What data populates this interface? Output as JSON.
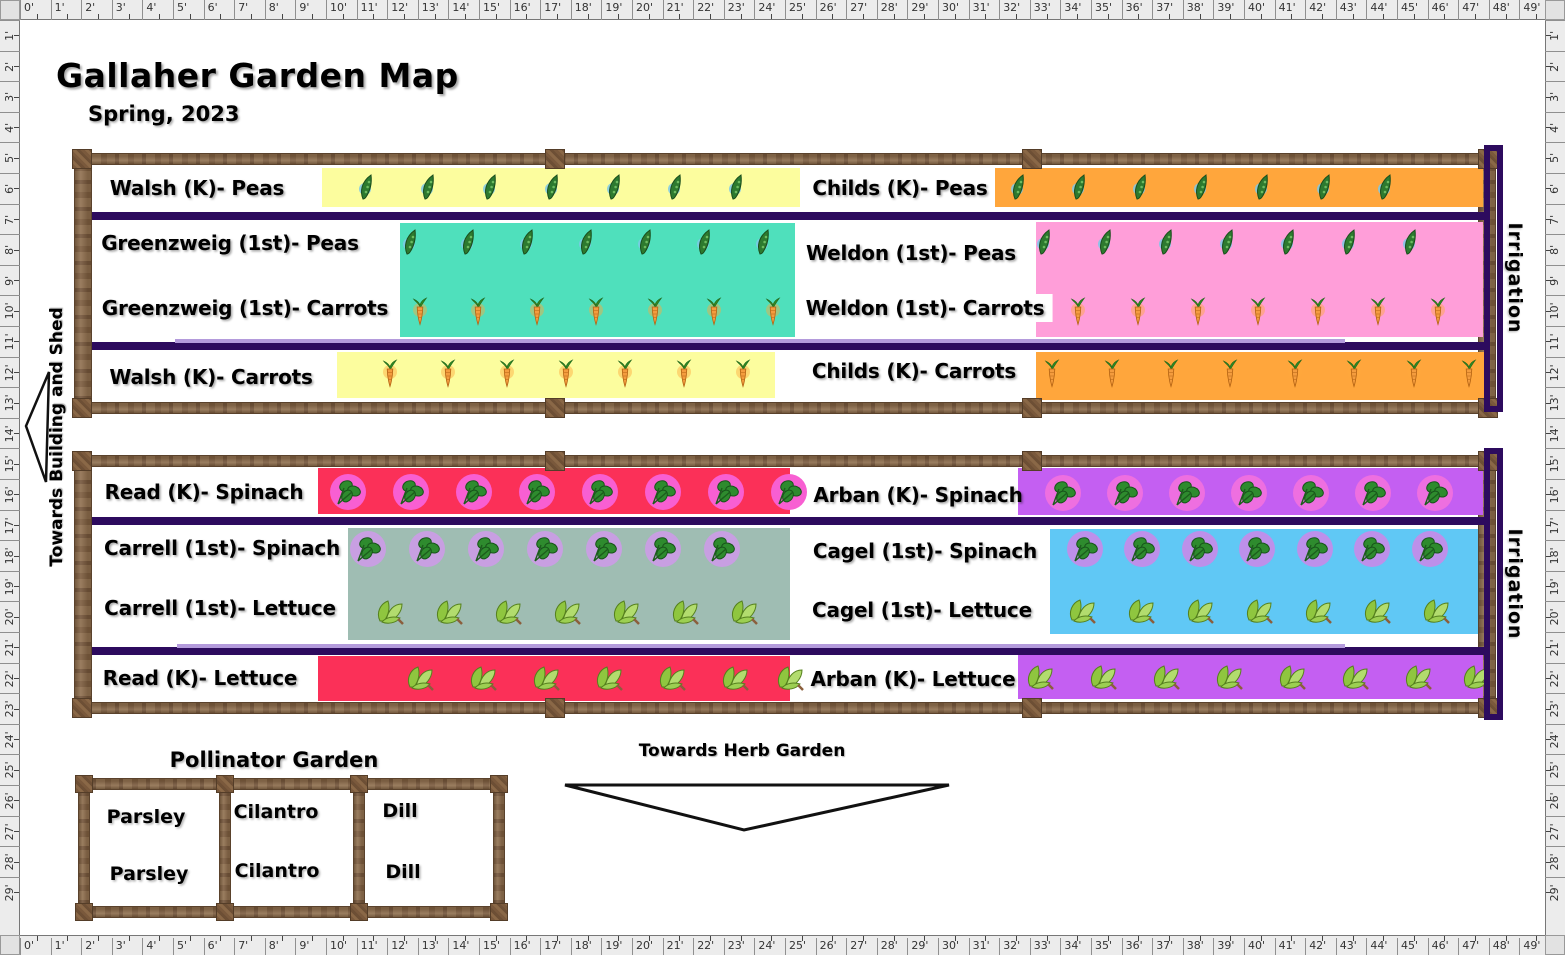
{
  "header": {
    "title": "Gallaher Garden Map",
    "subtitle": "Spring, 2023"
  },
  "palette": {
    "irrigation_line": "#2d0b5e",
    "light_irrigation_line": "#b49bdc",
    "wood": "#8a6a4a",
    "ruler_bg": "#ececec",
    "yellow_row": "#fcfd9e",
    "orange_row": "#ffa63c",
    "teal_row": "#4fe0bc",
    "pink_row": "#ff9ed9",
    "crimson_row": "#fb3058",
    "violet_row": "#c45ff2",
    "sage_row": "#9fbdb3",
    "blue_row": "#60c8f5"
  },
  "rulers": {
    "unit": 30.6,
    "thickness": 20,
    "h_labels": [
      "0'",
      "1'",
      "2'",
      "3'",
      "4'",
      "5'",
      "6'",
      "7'",
      "8'",
      "9'",
      "10'",
      "11'",
      "12'",
      "13'",
      "14'",
      "15'",
      "16'",
      "17'",
      "18'",
      "19'",
      "20'",
      "21'",
      "22'",
      "23'",
      "24'",
      "25'",
      "26'",
      "27'",
      "28'",
      "29'",
      "30'",
      "31'",
      "32'",
      "33'",
      "34'",
      "35'",
      "36'",
      "37'",
      "38'",
      "39'",
      "40'",
      "41'",
      "42'",
      "43'",
      "44'",
      "45'",
      "46'",
      "47'",
      "48'",
      "49'"
    ],
    "v_labels": [
      "1'",
      "2'",
      "3'",
      "4'",
      "5'",
      "6'",
      "7'",
      "8'",
      "9'",
      "10'",
      "11'",
      "12'",
      "13'",
      "14'",
      "15'",
      "16'",
      "17'",
      "18'",
      "19'",
      "20'",
      "21'",
      "22'",
      "23'",
      "24'",
      "25'",
      "26'",
      "27'",
      "28'",
      "29'"
    ]
  },
  "beds": [
    {
      "frame": {
        "x": 74,
        "y": 153,
        "w": 1422,
        "h": 261,
        "rail": 12,
        "vrail": 18
      },
      "posts_x": [
        545,
        1022
      ],
      "lines": [
        212,
        342
      ],
      "light_line": {
        "y": 339,
        "x1": 175,
        "x2": 1345
      },
      "rects": [
        {
          "x": 322,
          "y": 168,
          "w": 478,
          "h": 39,
          "color": "#fcfd9e"
        },
        {
          "x": 995,
          "y": 168,
          "w": 488,
          "h": 39,
          "color": "#ffa63c"
        },
        {
          "x": 400,
          "y": 223,
          "w": 395,
          "h": 114,
          "color": "#4fe0bc"
        },
        {
          "x": 1036,
          "y": 222,
          "w": 447,
          "h": 115,
          "color": "#ff9ed9"
        },
        {
          "x": 337,
          "y": 352,
          "w": 438,
          "h": 46,
          "color": "#fcfd9e"
        },
        {
          "x": 1036,
          "y": 352,
          "w": 448,
          "h": 48,
          "color": "#ffa63c"
        }
      ],
      "labels": [
        {
          "text": "Walsh (K)- Peas",
          "cx": 197,
          "cy": 188
        },
        {
          "text": "Childs (K)- Peas",
          "cx": 900,
          "cy": 188
        },
        {
          "text": "Greenzweig (1st)- Peas",
          "cx": 230,
          "cy": 243
        },
        {
          "text": "Greenzweig (1st)- Carrots",
          "cx": 245,
          "cy": 308
        },
        {
          "text": "Weldon (1st)- Peas",
          "cx": 911,
          "cy": 253
        },
        {
          "text": "Weldon (1st)- Carrots",
          "cx": 925,
          "cy": 308,
          "bg": "#ffffff"
        },
        {
          "text": "Walsh (K)- Carrots",
          "cx": 211,
          "cy": 377
        },
        {
          "text": "Childs (K)- Carrots",
          "cx": 914,
          "cy": 371
        }
      ],
      "icon_rows": [
        {
          "type": "pea",
          "cy": 187,
          "xs": [
            368,
            430,
            492,
            554,
            616,
            677,
            738
          ]
        },
        {
          "type": "pea",
          "cy": 187,
          "xs": [
            1020,
            1081,
            1142,
            1203,
            1264,
            1326,
            1387
          ]
        },
        {
          "type": "pea",
          "cy": 242,
          "xs": [
            412,
            470,
            529,
            588,
            647,
            706,
            765
          ]
        },
        {
          "type": "pea",
          "cy": 242,
          "xs": [
            1046,
            1107,
            1168,
            1229,
            1290,
            1351,
            1412
          ]
        },
        {
          "type": "carrot",
          "cy": 312,
          "xs": [
            420,
            478,
            537,
            596,
            655,
            714,
            773
          ]
        },
        {
          "type": "carrot",
          "cy": 312,
          "xs": [
            1078,
            1138,
            1198,
            1258,
            1318,
            1378,
            1438
          ]
        },
        {
          "type": "carrot",
          "cy": 374,
          "xs": [
            390,
            448,
            507,
            566,
            625,
            684,
            743
          ]
        },
        {
          "type": "carrot",
          "cy": 374,
          "xs": [
            1052,
            1112,
            1171,
            1230,
            1295,
            1354,
            1414,
            1469
          ]
        }
      ],
      "irrigation": {
        "label": "Irrigation",
        "bracket": {
          "x": 1484,
          "y": 145,
          "w": 19,
          "h": 267
        },
        "label_cx": 1515,
        "label_cy": 278
      }
    },
    {
      "frame": {
        "x": 74,
        "y": 455,
        "w": 1422,
        "h": 259,
        "rail": 12,
        "vrail": 18
      },
      "posts_x": [
        545,
        1022
      ],
      "lines": [
        517,
        647
      ],
      "light_line": {
        "y": 644,
        "x1": 177,
        "x2": 1345
      },
      "rects": [
        {
          "x": 318,
          "y": 468,
          "w": 472,
          "h": 46,
          "color": "#fb3058"
        },
        {
          "x": 1018,
          "y": 468,
          "w": 465,
          "h": 47,
          "color": "#c45ff2"
        },
        {
          "x": 348,
          "y": 528,
          "w": 442,
          "h": 112,
          "color": "#9fbdb3"
        },
        {
          "x": 1050,
          "y": 529,
          "w": 428,
          "h": 105,
          "color": "#60c8f5"
        },
        {
          "x": 318,
          "y": 656,
          "w": 472,
          "h": 45,
          "color": "#fb3058"
        },
        {
          "x": 1018,
          "y": 655,
          "w": 465,
          "h": 44,
          "color": "#c45ff2"
        }
      ],
      "labels": [
        {
          "text": "Read (K)- Spinach",
          "cx": 204,
          "cy": 492
        },
        {
          "text": "Arban (K)- Spinach",
          "cx": 918,
          "cy": 495
        },
        {
          "text": "Carrell (1st)- Spinach",
          "cx": 222,
          "cy": 548
        },
        {
          "text": "Carrell (1st)- Lettuce",
          "cx": 220,
          "cy": 608
        },
        {
          "text": "Cagel (1st)- Spinach",
          "cx": 925,
          "cy": 551
        },
        {
          "text": "Cagel (1st)- Lettuce",
          "cx": 922,
          "cy": 610
        },
        {
          "text": "Read (K)- Lettuce",
          "cx": 200,
          "cy": 678
        },
        {
          "text": "Arban (K)- Lettuce",
          "cx": 913,
          "cy": 679
        }
      ],
      "icon_rows": [
        {
          "type": "spinach",
          "cy": 492,
          "circle": "#f85fd2",
          "xs": [
            348,
            411,
            474,
            537,
            600,
            663,
            726,
            789
          ]
        },
        {
          "type": "spinach",
          "cy": 493,
          "circle": "#ee6fe0",
          "xs": [
            1063,
            1125,
            1187,
            1249,
            1311,
            1373,
            1435
          ]
        },
        {
          "type": "spinach",
          "cy": 549,
          "circle": "#c89fe2",
          "xs": [
            368,
            427,
            486,
            545,
            604,
            663,
            722
          ]
        },
        {
          "type": "spinach",
          "cy": 549,
          "circle": "#bd90ea",
          "xs": [
            1085,
            1142,
            1200,
            1257,
            1315,
            1372,
            1430
          ]
        },
        {
          "type": "lettuce",
          "cy": 612,
          "xs": [
            390,
            449,
            508,
            567,
            626,
            685,
            744
          ]
        },
        {
          "type": "lettuce",
          "cy": 611,
          "xs": [
            1082,
            1141,
            1200,
            1259,
            1318,
            1377,
            1436
          ]
        },
        {
          "type": "lettuce",
          "cy": 678,
          "xs": [
            420,
            483,
            546,
            609,
            672,
            735,
            790
          ]
        },
        {
          "type": "lettuce",
          "cy": 677,
          "xs": [
            1040,
            1103,
            1166,
            1229,
            1292,
            1355,
            1418,
            1476
          ]
        }
      ],
      "irrigation": {
        "label": "Irrigation",
        "bracket": {
          "x": 1484,
          "y": 448,
          "w": 19,
          "h": 272
        },
        "label_cx": 1515,
        "label_cy": 584
      }
    }
  ],
  "pollinator": {
    "title": "Pollinator Garden",
    "frame": {
      "x": 78,
      "y": 778,
      "w": 427,
      "h": 140,
      "rail": 12
    },
    "dividers_x": [
      219,
      353
    ],
    "posts_x": [
      75,
      213,
      347,
      484
    ],
    "labels": [
      {
        "text": "Parsley",
        "cx": 146,
        "cy": 817
      },
      {
        "text": "Cilantro",
        "cx": 276,
        "cy": 812
      },
      {
        "text": "Dill",
        "cx": 400,
        "cy": 811
      },
      {
        "text": "Parsley",
        "cx": 149,
        "cy": 874
      },
      {
        "text": "Cilantro",
        "cx": 277,
        "cy": 871
      },
      {
        "text": "Dill",
        "cx": 403,
        "cy": 872
      }
    ]
  },
  "annotations": {
    "herb": {
      "text": "Towards Herb Garden"
    },
    "shed": {
      "text": "Towards Building and Shed"
    }
  }
}
